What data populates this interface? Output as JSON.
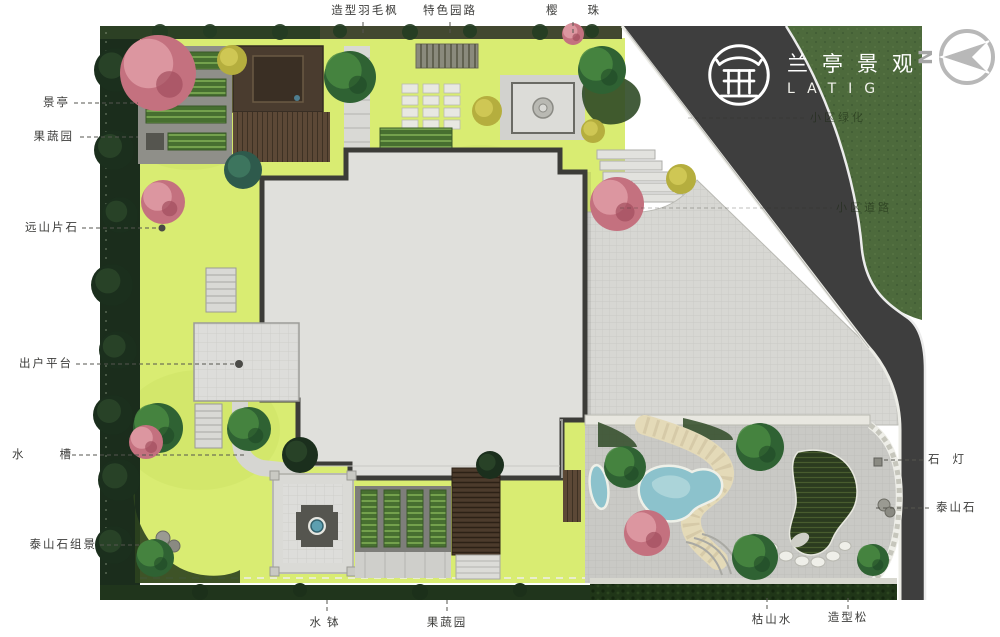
{
  "logo": {
    "name_cn": "兰亭景观",
    "name_en": "LATIG",
    "seal_icon": "pavilion-seal-icon"
  },
  "compass": {
    "label": "N"
  },
  "annotations": {
    "top": [
      {
        "label": "造型羽毛枫"
      },
      {
        "label": "特色园路"
      },
      {
        "label": "樱珠"
      }
    ],
    "left": [
      {
        "label": "景亭"
      },
      {
        "label": "果蔬园"
      },
      {
        "label": "远山片石"
      },
      {
        "label": "出户平台"
      },
      {
        "label": "水槽"
      },
      {
        "label": "泰山石组景"
      }
    ],
    "right": [
      {
        "label": "石灯"
      },
      {
        "label": "泰山石"
      }
    ],
    "bottom": [
      {
        "label": "水钵"
      },
      {
        "label": "果蔬园"
      },
      {
        "label": "枯山水"
      },
      {
        "label": "造型松"
      }
    ],
    "faint": [
      {
        "label": "小区绿化"
      },
      {
        "label": "小区道路"
      }
    ]
  },
  "colors": {
    "lawn": "#d9ec72",
    "paving": "#d7d7d3",
    "house_fill": "#e0e0dc",
    "house_wall": "#3c3c38",
    "road": "#3e3e3e",
    "verge_green": "#4d6a3c",
    "border_green": "#1b2d1c",
    "pool_blue": "#8cc2cc",
    "stone_path": "#e4dab8",
    "deck_brown": "#5c4836",
    "label_text": "#3d3d3b",
    "logo_white": "#ffffff"
  }
}
